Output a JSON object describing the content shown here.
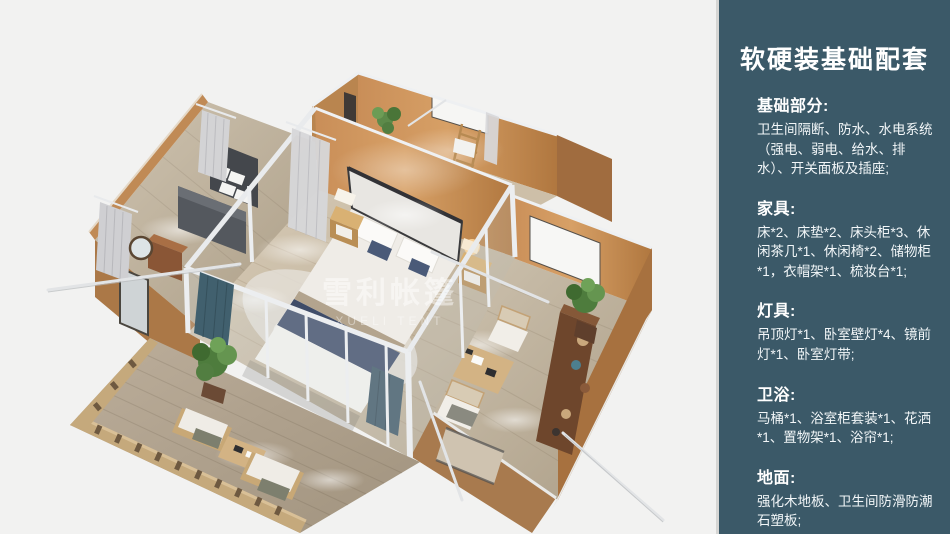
{
  "panel": {
    "title": "软硬装基础配套",
    "sections": [
      {
        "heading": "基础部分:",
        "body": "卫生间隔断、防水、水电系统（强电、弱电、给水、排水）、开关面板及插座;"
      },
      {
        "heading": "家具:",
        "body": "床*2、床垫*2、床头柜*3、休闲茶几*1、休闲椅*2、储物柜*1，衣帽架*1、梳妆台*1;"
      },
      {
        "heading": "灯具:",
        "body": "吊顶灯*1、卧室壁灯*4、镜前灯*1、卧室灯带;"
      },
      {
        "heading": "卫浴:",
        "body": "马桶*1、浴室柜套装*1、花洒*1、置物架*1、浴帘*1;"
      },
      {
        "heading": "地面:",
        "body": "强化木地板、卫生间防滑防潮石塑板;"
      }
    ]
  },
  "watermark": {
    "cjk": "雪利帐篷",
    "latin": "XUELI TENT"
  },
  "colors": {
    "sidebar_bg": "#3b5968",
    "divider": "#d6d6d4",
    "canvas_bg": "#f2f2f1",
    "wall_orange": "#c08455",
    "wall_shadow": "#a06c3f",
    "floor_wood": "#cfc3ae",
    "deck_wood": "#b3a694",
    "frame_white": "#eceef0",
    "bed_runner_navy": "#3f4c68",
    "curtain_teal": "#41606e",
    "plant_green": "#5d8a4a"
  }
}
